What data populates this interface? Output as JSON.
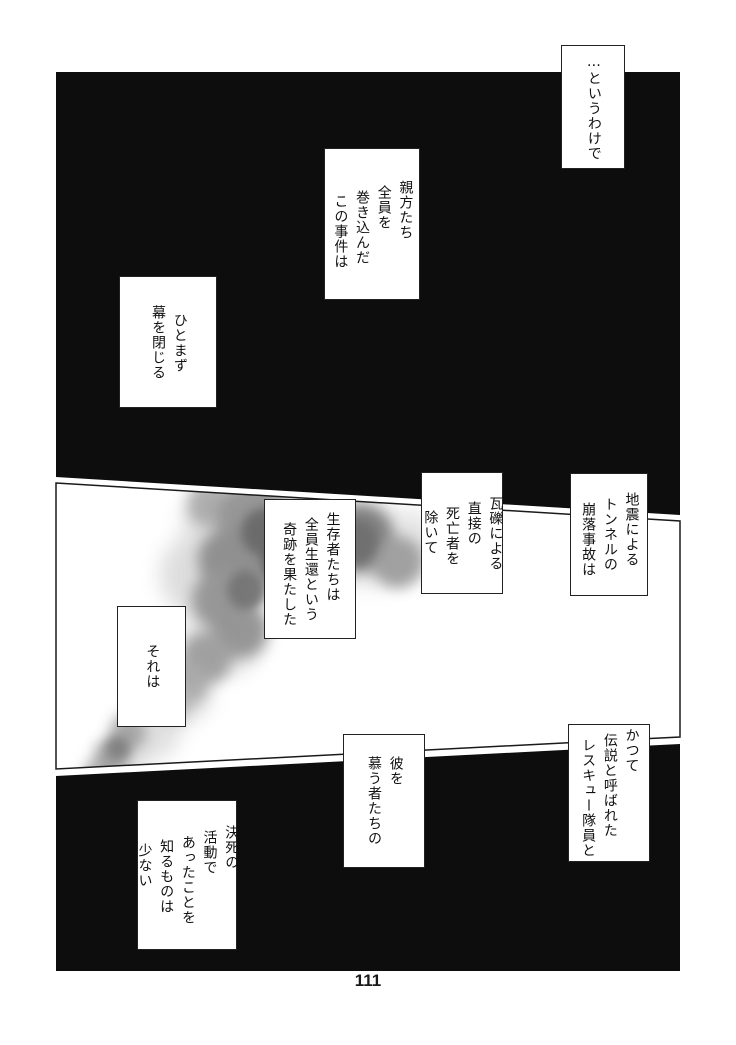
{
  "page": {
    "number": "111",
    "paper_color": "#ffffff",
    "ink_color": "#0d0d0d",
    "smoke_colors": [
      "#d2d2d2",
      "#8f8f8f",
      "#646464"
    ]
  },
  "balloons": [
    {
      "name": "narration-intro",
      "columns": [
        "…というわけで"
      ]
    },
    {
      "name": "narration-incident",
      "columns": [
        "親方たち",
        "全員を",
        "巻き込んだ",
        "この事件は"
      ]
    },
    {
      "name": "narration-curtain",
      "columns": [
        "ひとまず",
        "幕を閉じる"
      ]
    },
    {
      "name": "narration-earthquake",
      "columns": [
        "地震による",
        "トンネルの",
        "崩落事故は"
      ]
    },
    {
      "name": "narration-casualties",
      "columns": [
        "瓦礫による",
        "直接の",
        "死亡者を",
        "除いて"
      ]
    },
    {
      "name": "narration-miracle",
      "columns": [
        "生存者たちは",
        "全員生還という",
        "奇跡を果たした"
      ]
    },
    {
      "name": "narration-sore",
      "columns": [
        "それは"
      ]
    },
    {
      "name": "narration-rescuer",
      "columns": [
        "かつて",
        "伝説と呼ばれた",
        "レスキュー隊員と"
      ]
    },
    {
      "name": "narration-admirers",
      "columns": [
        "彼を",
        "慕う者たちの"
      ]
    },
    {
      "name": "narration-secret",
      "columns": [
        "決死の",
        "活動で",
        "あったことを",
        "知るものは",
        "少ない"
      ]
    }
  ]
}
